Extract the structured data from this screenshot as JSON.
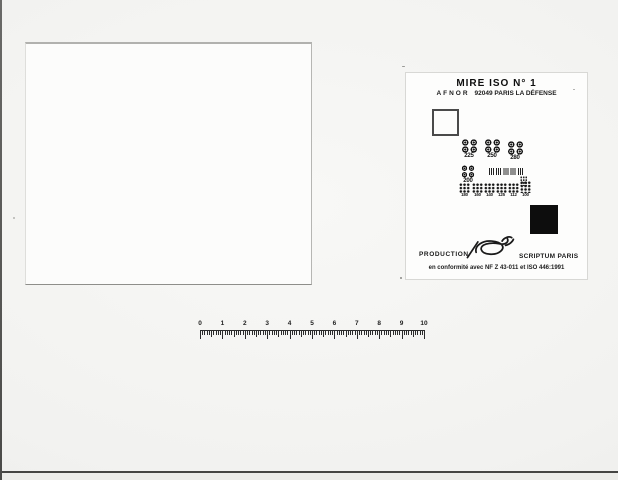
{
  "scan": {
    "background_color": "#f2f2f0"
  },
  "test_chart": {
    "title": "MIRE ISO N° 1",
    "organization": "AFNOR",
    "address": "92049 PARIS LA DÉFENSE",
    "production_label": "PRODUCTION",
    "producer": "SCRIPTUM PARIS",
    "conformity_note": "en conformité avec NF Z 43-011 et ISO 446:1991",
    "pattern_labels": {
      "row1": [
        "225",
        "250",
        "280"
      ],
      "row2": [
        "200"
      ],
      "row3": [
        "180",
        "160",
        "140",
        "125",
        "112",
        "100"
      ]
    },
    "calibration_patches": [
      "white-square",
      "black-square"
    ]
  },
  "ruler": {
    "numbers": [
      "0",
      "1",
      "2",
      "3",
      "4",
      "5",
      "6",
      "7",
      "8",
      "9",
      "10"
    ],
    "minor_ticks_per_unit": 10,
    "unit_px": 22.4
  }
}
